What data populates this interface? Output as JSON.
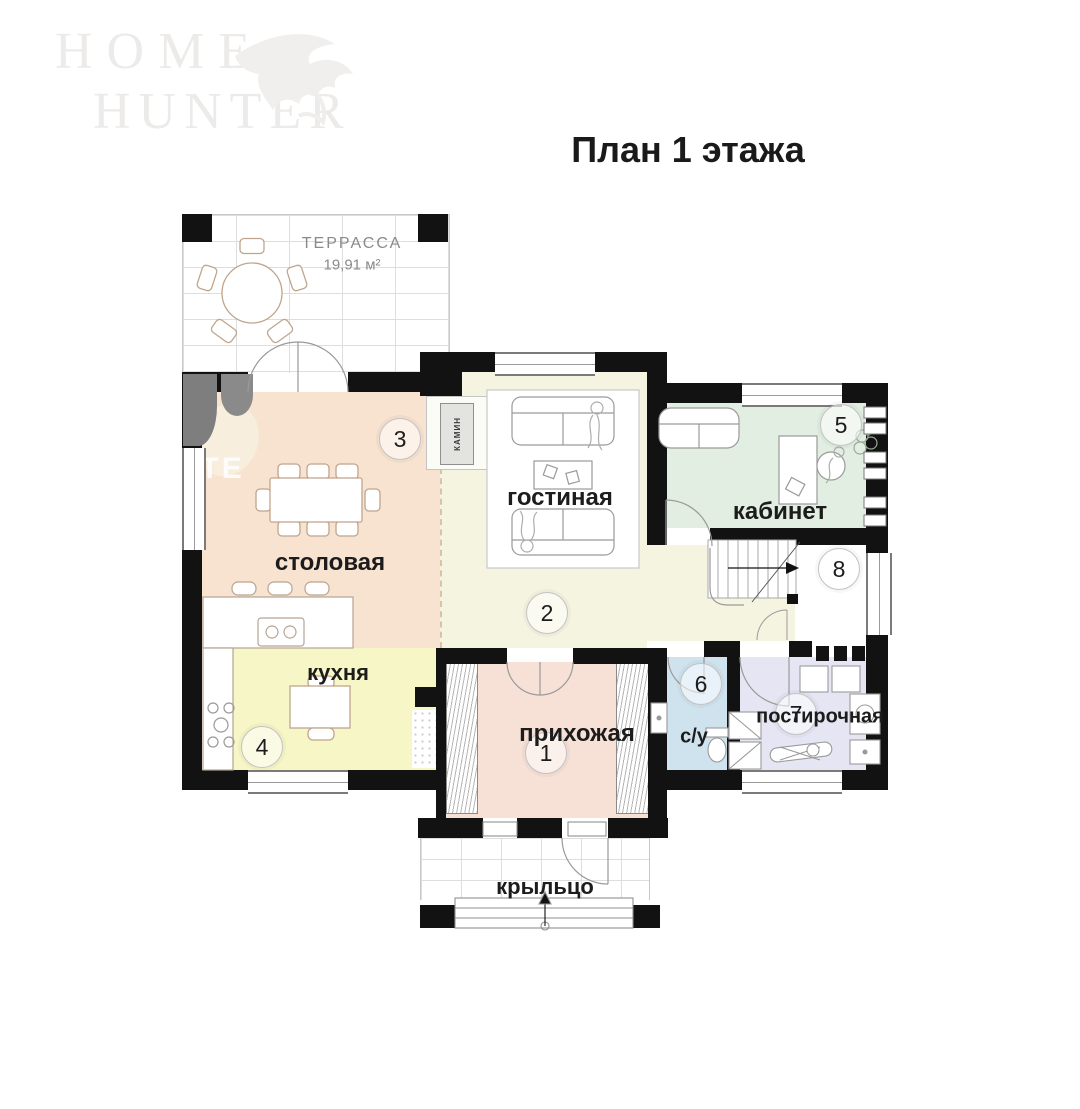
{
  "page": {
    "title": "План 1 этажа"
  },
  "logo": {
    "line1": "HOME",
    "line2": "HUNTER"
  },
  "watermark": {
    "text": "ATE"
  },
  "plan": {
    "rooms": {
      "terrace": {
        "label": "ТЕРРАССА",
        "area": "19,91 м²"
      },
      "hallway": {
        "number": "1",
        "label": "прихожая",
        "color": "#f7e0d5"
      },
      "living": {
        "number": "2",
        "label": "гостиная",
        "color": "#f4f4e1"
      },
      "dining": {
        "number": "3",
        "label": "столовая",
        "color": "#f8e3d0"
      },
      "kitchen": {
        "number": "4",
        "label": "кухня",
        "color": "#f6f6c6"
      },
      "office": {
        "number": "5",
        "label": "кабинет",
        "color": "#e2eee1"
      },
      "wc": {
        "number": "6",
        "label": "с/у",
        "color": "#cfe3ef"
      },
      "laundry": {
        "number": "7",
        "label": "постирочная",
        "color": "#e5e5f3"
      },
      "stairs": {
        "number": "8"
      },
      "porch": {
        "label": "крыльцо"
      }
    },
    "annotations": {
      "fireplace": "КАМИН"
    }
  }
}
